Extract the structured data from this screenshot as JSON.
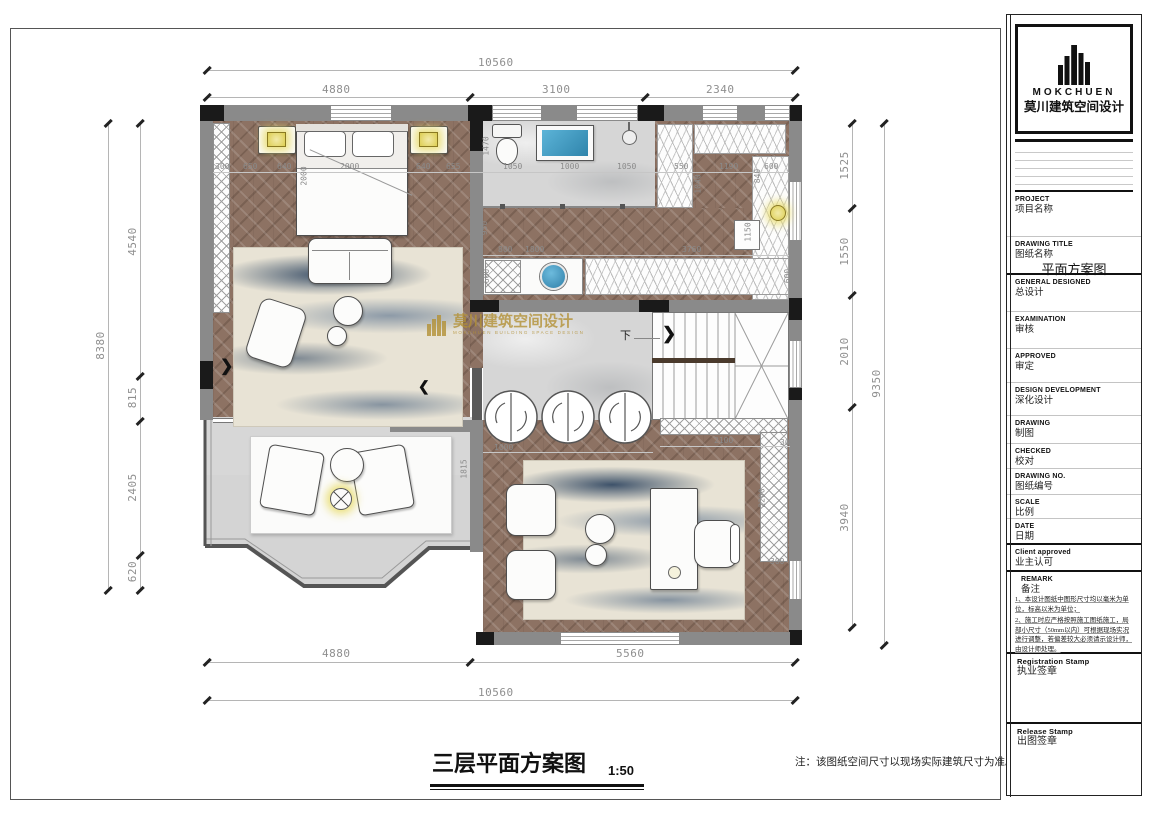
{
  "sheet": {
    "footer_title": "三层平面方案图",
    "footer_scale": "1:50",
    "footer_note": "注：该图纸空间尺寸以现场实际建筑尺寸为准。"
  },
  "logo": {
    "en": "MOKCHUEN",
    "cn": "莫川建筑空间设计"
  },
  "watermark": {
    "cn": "莫川建筑空间设计",
    "en": "MOKCHUEN BUILDING SPACE DESIGN"
  },
  "stair": {
    "down": "下"
  },
  "title_block": {
    "fields": [
      {
        "en": "PROJECT",
        "cn": "项目名称",
        "value": ""
      },
      {
        "en": "DRAWING TITLE",
        "cn": "图纸名称",
        "value": "平面方案图"
      },
      {
        "en": "GENERAL  DESIGNED",
        "cn": "总设计",
        "value": ""
      },
      {
        "en": "EXAMINATION",
        "cn": "审核",
        "value": ""
      },
      {
        "en": "APPROVED",
        "cn": "审定",
        "value": ""
      },
      {
        "en": "DESIGN DEVELOPMENT",
        "cn": "深化设计",
        "value": ""
      },
      {
        "en": "DRAWING",
        "cn": "制图",
        "value": ""
      },
      {
        "en": "CHECKED",
        "cn": "校对",
        "value": ""
      },
      {
        "en": "DRAWING NO.",
        "cn": "图纸编号",
        "value": ""
      },
      {
        "en": "SCALE",
        "cn": "比例",
        "value": ""
      },
      {
        "en": "DATE",
        "cn": "日期",
        "value": ""
      },
      {
        "en": "Client approved",
        "cn": "业主认可",
        "value": ""
      }
    ],
    "remark_en": "REMARK",
    "remark_cn": "备注",
    "notes": [
      "1、本设计图纸中图形尺寸均以毫米为单位，标高以米为单位；",
      "2、施工时应严格按照施工图纸施工，局部小尺寸（50mm以内）可根据现场实况进行调整，若偏差较大必须请示设计师，由设计师处理。"
    ],
    "stamps": [
      {
        "en": "Registration Stamp",
        "cn": "执业签章"
      },
      {
        "en": "Release Stamp",
        "cn": "出图签章"
      }
    ]
  },
  "dims": {
    "top_total": "10560",
    "top_parts": [
      "4880",
      "3100",
      "2340"
    ],
    "left_total": "8380",
    "left_parts": [
      "4540",
      "815",
      "2405",
      "620"
    ],
    "right_total": "9350",
    "right_parts": [
      "1525",
      "1550",
      "2010",
      "3940"
    ],
    "bottom_parts": [
      "4880",
      "5560"
    ],
    "bottom_total": "10560"
  },
  "plan_dims": [
    "300",
    "650",
    "640",
    "2000",
    "640",
    "655",
    "1470",
    "2000",
    "1050",
    "1000",
    "1050",
    "550",
    "1190",
    "600",
    "1040",
    "840",
    "1150",
    "950",
    "800",
    "1800",
    "3760",
    "600",
    "600",
    "1000",
    "2100",
    "300",
    "1815",
    "2290",
    "300"
  ],
  "colors": {
    "wood": "#8d7263",
    "marble": "#d6d6d6",
    "wall": "#8a8a8a",
    "wall_dark": "#1a1a1a",
    "water_blue": "#45a3c9",
    "lamp_glow": "#ece28a",
    "rug_blue": "#41597a",
    "watermark_gold": "#b39136"
  }
}
